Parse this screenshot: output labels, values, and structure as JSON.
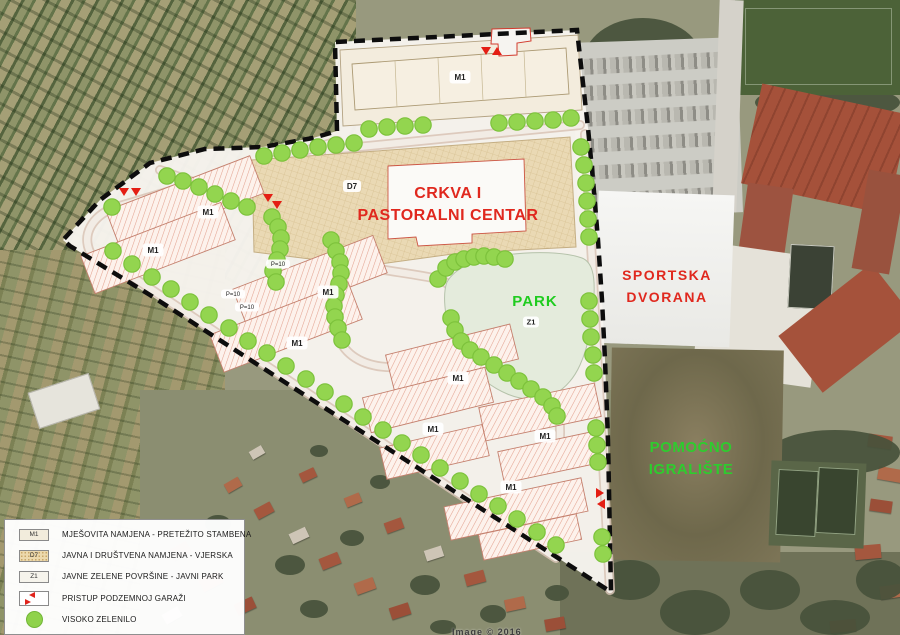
{
  "map": {
    "labels": {
      "church": {
        "line1": "CRKVA I",
        "line2": "PASTORALNI CENTAR"
      },
      "sports_hall": {
        "line1": "SPORTSKA",
        "line2": "DVORANA"
      },
      "park": {
        "name": "PARK",
        "zone": "Z1"
      },
      "aux_field": {
        "line1": "POMOĆNO",
        "line2": "IGRALIŠTE"
      }
    },
    "zone_badges": {
      "m1": {
        "label": "M1",
        "positions": [
          [
            460,
            77
          ],
          [
            208,
            212
          ],
          [
            153,
            250
          ],
          [
            328,
            292
          ],
          [
            297,
            343
          ],
          [
            458,
            378
          ],
          [
            433,
            429
          ],
          [
            545,
            436
          ],
          [
            511,
            487
          ]
        ]
      },
      "d7": {
        "label": "D7",
        "position": [
          352,
          186
        ]
      },
      "z1": {
        "label": "Z1",
        "position": [
          531,
          322
        ]
      },
      "p10": {
        "label": "P=10",
        "positions": [
          [
            278,
            264
          ],
          [
            233,
            294
          ],
          [
            247,
            307
          ]
        ]
      }
    },
    "markers": {
      "green_dots": [
        [
          369,
          129
        ],
        [
          387,
          127
        ],
        [
          405,
          126
        ],
        [
          423,
          125
        ],
        [
          499,
          123
        ],
        [
          517,
          122
        ],
        [
          535,
          121
        ],
        [
          553,
          120
        ],
        [
          571,
          118
        ],
        [
          581,
          147
        ],
        [
          584,
          165
        ],
        [
          586,
          183
        ],
        [
          587,
          201
        ],
        [
          588,
          219
        ],
        [
          589,
          237
        ],
        [
          589,
          301
        ],
        [
          590,
          319
        ],
        [
          591,
          337
        ],
        [
          593,
          355
        ],
        [
          594,
          373
        ],
        [
          596,
          428
        ],
        [
          597,
          445
        ],
        [
          598,
          462
        ],
        [
          602,
          537
        ],
        [
          603,
          554
        ],
        [
          264,
          156
        ],
        [
          282,
          153
        ],
        [
          300,
          150
        ],
        [
          318,
          147
        ],
        [
          336,
          145
        ],
        [
          354,
          143
        ],
        [
          167,
          176
        ],
        [
          183,
          181
        ],
        [
          199,
          187
        ],
        [
          215,
          194
        ],
        [
          231,
          201
        ],
        [
          247,
          207
        ],
        [
          113,
          251
        ],
        [
          132,
          264
        ],
        [
          152,
          277
        ],
        [
          171,
          289
        ],
        [
          190,
          302
        ],
        [
          209,
          315
        ],
        [
          229,
          328
        ],
        [
          248,
          341
        ],
        [
          267,
          353
        ],
        [
          286,
          366
        ],
        [
          306,
          379
        ],
        [
          325,
          392
        ],
        [
          344,
          404
        ],
        [
          363,
          417
        ],
        [
          383,
          430
        ],
        [
          402,
          443
        ],
        [
          421,
          455
        ],
        [
          440,
          468
        ],
        [
          460,
          481
        ],
        [
          479,
          494
        ],
        [
          498,
          506
        ],
        [
          517,
          519
        ],
        [
          537,
          532
        ],
        [
          556,
          545
        ],
        [
          331,
          240
        ],
        [
          336,
          251
        ],
        [
          340,
          262
        ],
        [
          341,
          273
        ],
        [
          339,
          284
        ],
        [
          336,
          295
        ],
        [
          334,
          306
        ],
        [
          335,
          317
        ],
        [
          338,
          328
        ],
        [
          342,
          340
        ],
        [
          272,
          217
        ],
        [
          278,
          227
        ],
        [
          281,
          238
        ],
        [
          280,
          249
        ],
        [
          277,
          260
        ],
        [
          273,
          271
        ],
        [
          276,
          282
        ],
        [
          438,
          279
        ],
        [
          446,
          268
        ],
        [
          455,
          262
        ],
        [
          464,
          259
        ],
        [
          474,
          257
        ],
        [
          484,
          256
        ],
        [
          494,
          257
        ],
        [
          505,
          259
        ],
        [
          451,
          318
        ],
        [
          455,
          330
        ],
        [
          461,
          341
        ],
        [
          470,
          350
        ],
        [
          481,
          357
        ],
        [
          494,
          365
        ],
        [
          507,
          373
        ],
        [
          519,
          381
        ],
        [
          531,
          389
        ],
        [
          543,
          397
        ],
        [
          552,
          406
        ],
        [
          557,
          416
        ],
        [
          112,
          207
        ]
      ],
      "garage_access": [
        {
          "x": 486,
          "y": 51,
          "dir": "down"
        },
        {
          "x": 497,
          "y": 51,
          "dir": "up"
        },
        {
          "x": 124,
          "y": 192,
          "dir": "down"
        },
        {
          "x": 136,
          "y": 192,
          "dir": "down"
        },
        {
          "x": 268,
          "y": 198,
          "dir": "down"
        },
        {
          "x": 277,
          "y": 205,
          "dir": "down"
        },
        {
          "x": 600,
          "y": 493,
          "dir": "right"
        },
        {
          "x": 601,
          "y": 504,
          "dir": "left"
        }
      ]
    },
    "colors": {
      "tree_green": "#93d54f",
      "tree_green_edge": "#7cc23b",
      "zone_red": "#e0281e",
      "park_green": "#1fcc1f",
      "aux_green": "#2ecc2e",
      "garage_red": "#e41e14",
      "boundary": "#0d0d0d"
    }
  },
  "legend": {
    "items": [
      {
        "code": "M1",
        "label": "MJEŠOVITA NAMJENA - PRETEŽITO STAMBENA",
        "swatch": "m1"
      },
      {
        "code": "D7",
        "label": "JAVNA I DRUŠTVENA NAMJENA - VJERSKA",
        "swatch": "d7"
      },
      {
        "code": "Z1",
        "label": "JAVNE ZELENE POVRŠINE - JAVNI PARK",
        "swatch": "z1"
      },
      {
        "code": "",
        "label": "PRISTUP PODZEMNOJ GARAŽI",
        "swatch": "garage"
      },
      {
        "code": "",
        "label": "VISOKO ZELENILO",
        "swatch": "tree"
      }
    ]
  },
  "watermark": "Image © 2016"
}
